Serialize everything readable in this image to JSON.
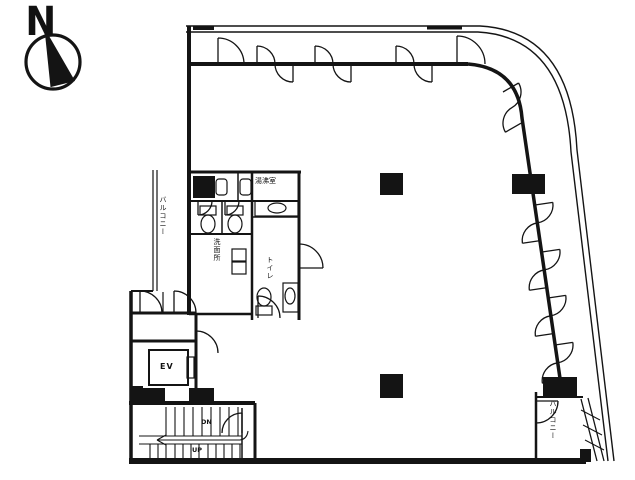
{
  "compass": {
    "label": "N"
  },
  "labels": {
    "balcony_left": "バルコニー",
    "balcony_right": "バルコニー",
    "elevator": "EV",
    "stairs_down": "DN",
    "stairs_up": "UP",
    "kitchenette": "湯沸室",
    "washroom": "洗面所",
    "toilet": "トイレ"
  },
  "colors": {
    "line": "#141414",
    "background": "#ffffff"
  }
}
